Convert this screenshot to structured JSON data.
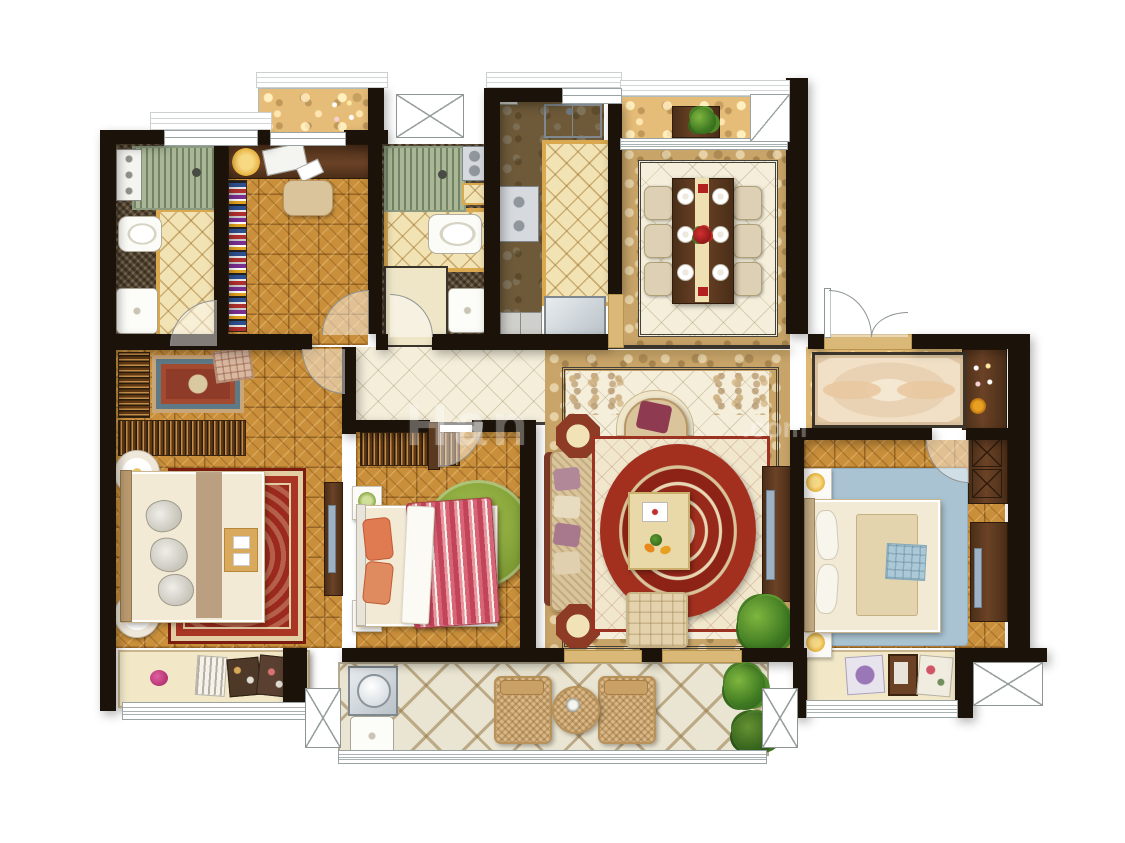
{
  "canvas": {
    "width": 1125,
    "height": 843,
    "background": "#ffffff"
  },
  "watermark": {
    "fragment_left": "Han",
    "fragment_right": ".com",
    "color": "#ffffff",
    "opacity": 0.32
  },
  "palette": {
    "wall": "#1b120a",
    "parquet": "#c98f3b",
    "walnut": "#5a3920",
    "tile_cream": "#f4eedb",
    "marble_band": "#c8a468",
    "diamond_tile": "#f2e3b4",
    "diamond_border": "#d9a84f",
    "mosaic_dark": "#5c4a32",
    "shower_mat": "#a9b796",
    "rug_red": "#9c2a1c",
    "rug_green": "#85a23c",
    "rug_blue": "#a9c3d2",
    "sofa_tan": "#d9c49b",
    "accent_red": "#9e2b1f",
    "counter_dark": "#56422e",
    "balcony_tile": "#eae5d2",
    "window_line": "#9aa3a3",
    "steel": "#cfd6da",
    "bay_sill": "#f2e8c8"
  },
  "floorplan": {
    "type": "residential-apartment-plan",
    "rooms": [
      {
        "name": "bathroom-1",
        "floor": "mosaic-and-diamond-tile",
        "fixtures": [
          "shower-with-mat",
          "control-panel",
          "toilet",
          "washbasin",
          "door-swing"
        ]
      },
      {
        "name": "study",
        "floor": "parquet",
        "fixtures": [
          "desk",
          "desk-lamp",
          "laptop",
          "notepad",
          "chair",
          "bookshelf",
          "door-swing"
        ]
      },
      {
        "name": "top-balcony",
        "floor": "marble",
        "fixtures": [
          "potted-plant"
        ]
      },
      {
        "name": "bathroom-2",
        "floor": "mosaic-and-diamond-tile",
        "fixtures": [
          "shower-with-mat",
          "control-panel",
          "toilet",
          "washbasin",
          "door-swing"
        ]
      },
      {
        "name": "kitchen",
        "floor": "diamond-tile",
        "fixtures": [
          "double-sink",
          "two-burner-cooktop",
          "refrigerator",
          "cabinets",
          "counter"
        ]
      },
      {
        "name": "dining-room",
        "floor": "cream-tile-with-marble-border",
        "fixtures": [
          "dining-table",
          "table-runner",
          "six-chairs",
          "six-plates",
          "rose-centerpiece",
          "bay-counter-plant"
        ]
      },
      {
        "name": "entry-hall",
        "floor": "marble",
        "fixtures": [
          "ornate-runner-rug",
          "flower-pot",
          "double-entry-door"
        ]
      },
      {
        "name": "living-room",
        "floor": "cream-tile-with-marble-border",
        "fixtures": [
          "sofa-with-pillows",
          "two-octagonal-side-tables",
          "armchair",
          "oval-red-rug",
          "coffee-table",
          "ottoman",
          "tv-cabinet",
          "plant",
          "corner-ornaments"
        ]
      },
      {
        "name": "master-bedroom",
        "floor": "parquet",
        "fixtures": [
          "double-bed",
          "red-oriental-rug",
          "small-oriental-rug",
          "ottoman-pouf",
          "slatted-wardrobe",
          "slatted-dresser",
          "two-round-nightstands",
          "bed-tray",
          "tv-cabinet",
          "door-swing"
        ]
      },
      {
        "name": "bedroom-2",
        "floor": "parquet",
        "fixtures": [
          "bed-with-striped-duvet",
          "white-sheet",
          "green-round-rug",
          "slatted-wardrobe",
          "two-nightstands",
          "door-swing"
        ]
      },
      {
        "name": "bedroom-3",
        "floor": "parquet",
        "fixtures": [
          "double-bed",
          "blue-rug",
          "x-front-wardrobe",
          "tv-cabinet",
          "two-nightstands",
          "door-swing"
        ]
      },
      {
        "name": "laundry-balcony",
        "floor": "large-diamond-tile",
        "fixtures": [
          "washing-machine",
          "laundry-sink",
          "two-wicker-chairs",
          "round-wicker-table",
          "plants"
        ]
      },
      {
        "name": "master-bay-window",
        "floor": "sill",
        "fixtures": [
          "striped-pillow",
          "floral-pillows",
          "flower"
        ]
      },
      {
        "name": "bedroom-3-bay-window",
        "floor": "sill",
        "fixtures": [
          "purple-pillow",
          "picture-frame",
          "floral-pillow"
        ]
      }
    ],
    "symbols": [
      "door-swing-arcs",
      "double-line-windows",
      "diagonal-corner-window",
      "ac-platform-x-boxes",
      "thresholds"
    ]
  }
}
